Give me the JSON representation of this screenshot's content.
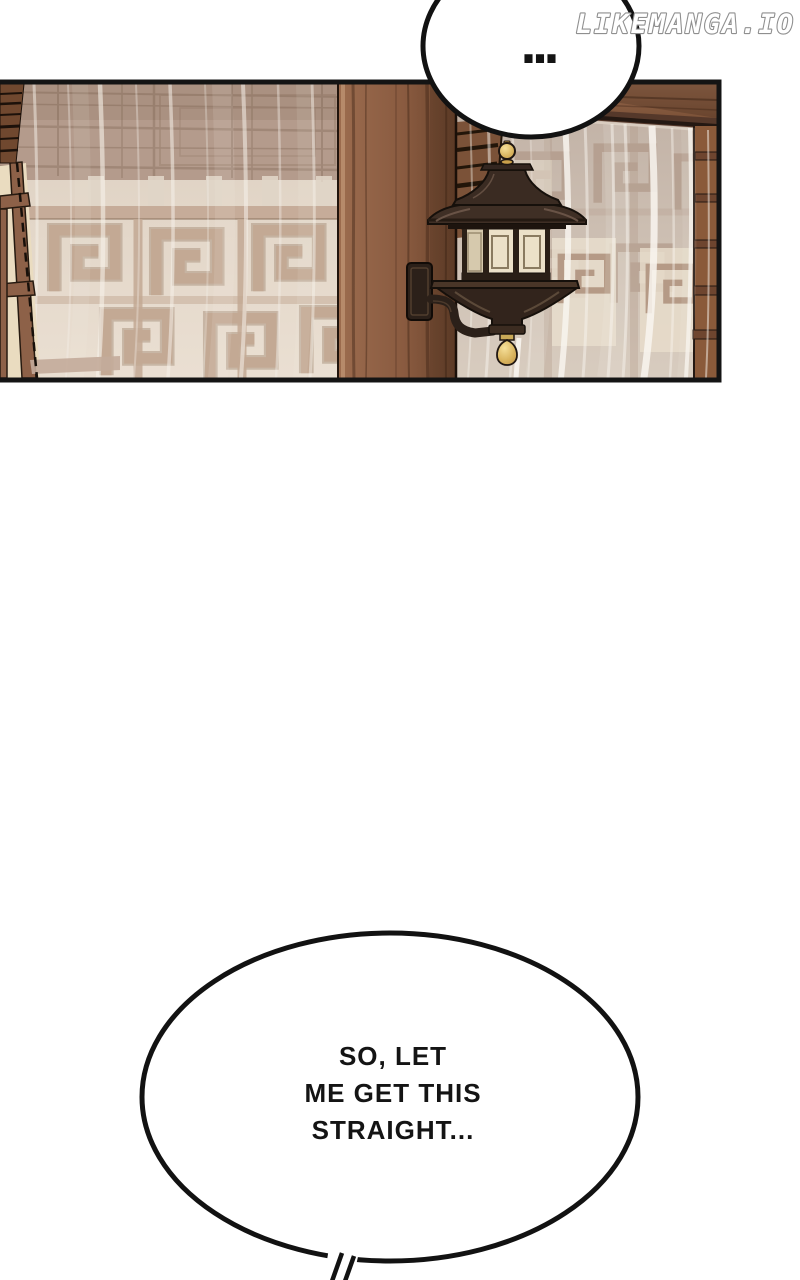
{
  "page": {
    "background": "#ffffff"
  },
  "watermark": {
    "text": "LIKEMANGA.IO",
    "fill": "#ffffff",
    "outline": "#8f8f8f"
  },
  "speech_bubbles": {
    "top": {
      "text": "..."
    },
    "bottom": {
      "lines": [
        "SO, LET",
        "ME GET THIS",
        "STRAIGHT..."
      ]
    }
  },
  "panel": {
    "scene": "lattice-window-wall-with-sheer-curtains-wood-pillar-and-pagoda-wall-lantern",
    "border_color": "#141414"
  },
  "colors": {
    "ink": "#141414",
    "pillar_wood": "#8a5b40",
    "dark_wood": "#3a2a20",
    "lattice_cream": "#e8ddcf",
    "lattice_taupe": "#c3a994",
    "upper_wall_taupe": "#b49b8c",
    "curtain_right": "#c9bab0",
    "gold": "#d9b45e"
  }
}
